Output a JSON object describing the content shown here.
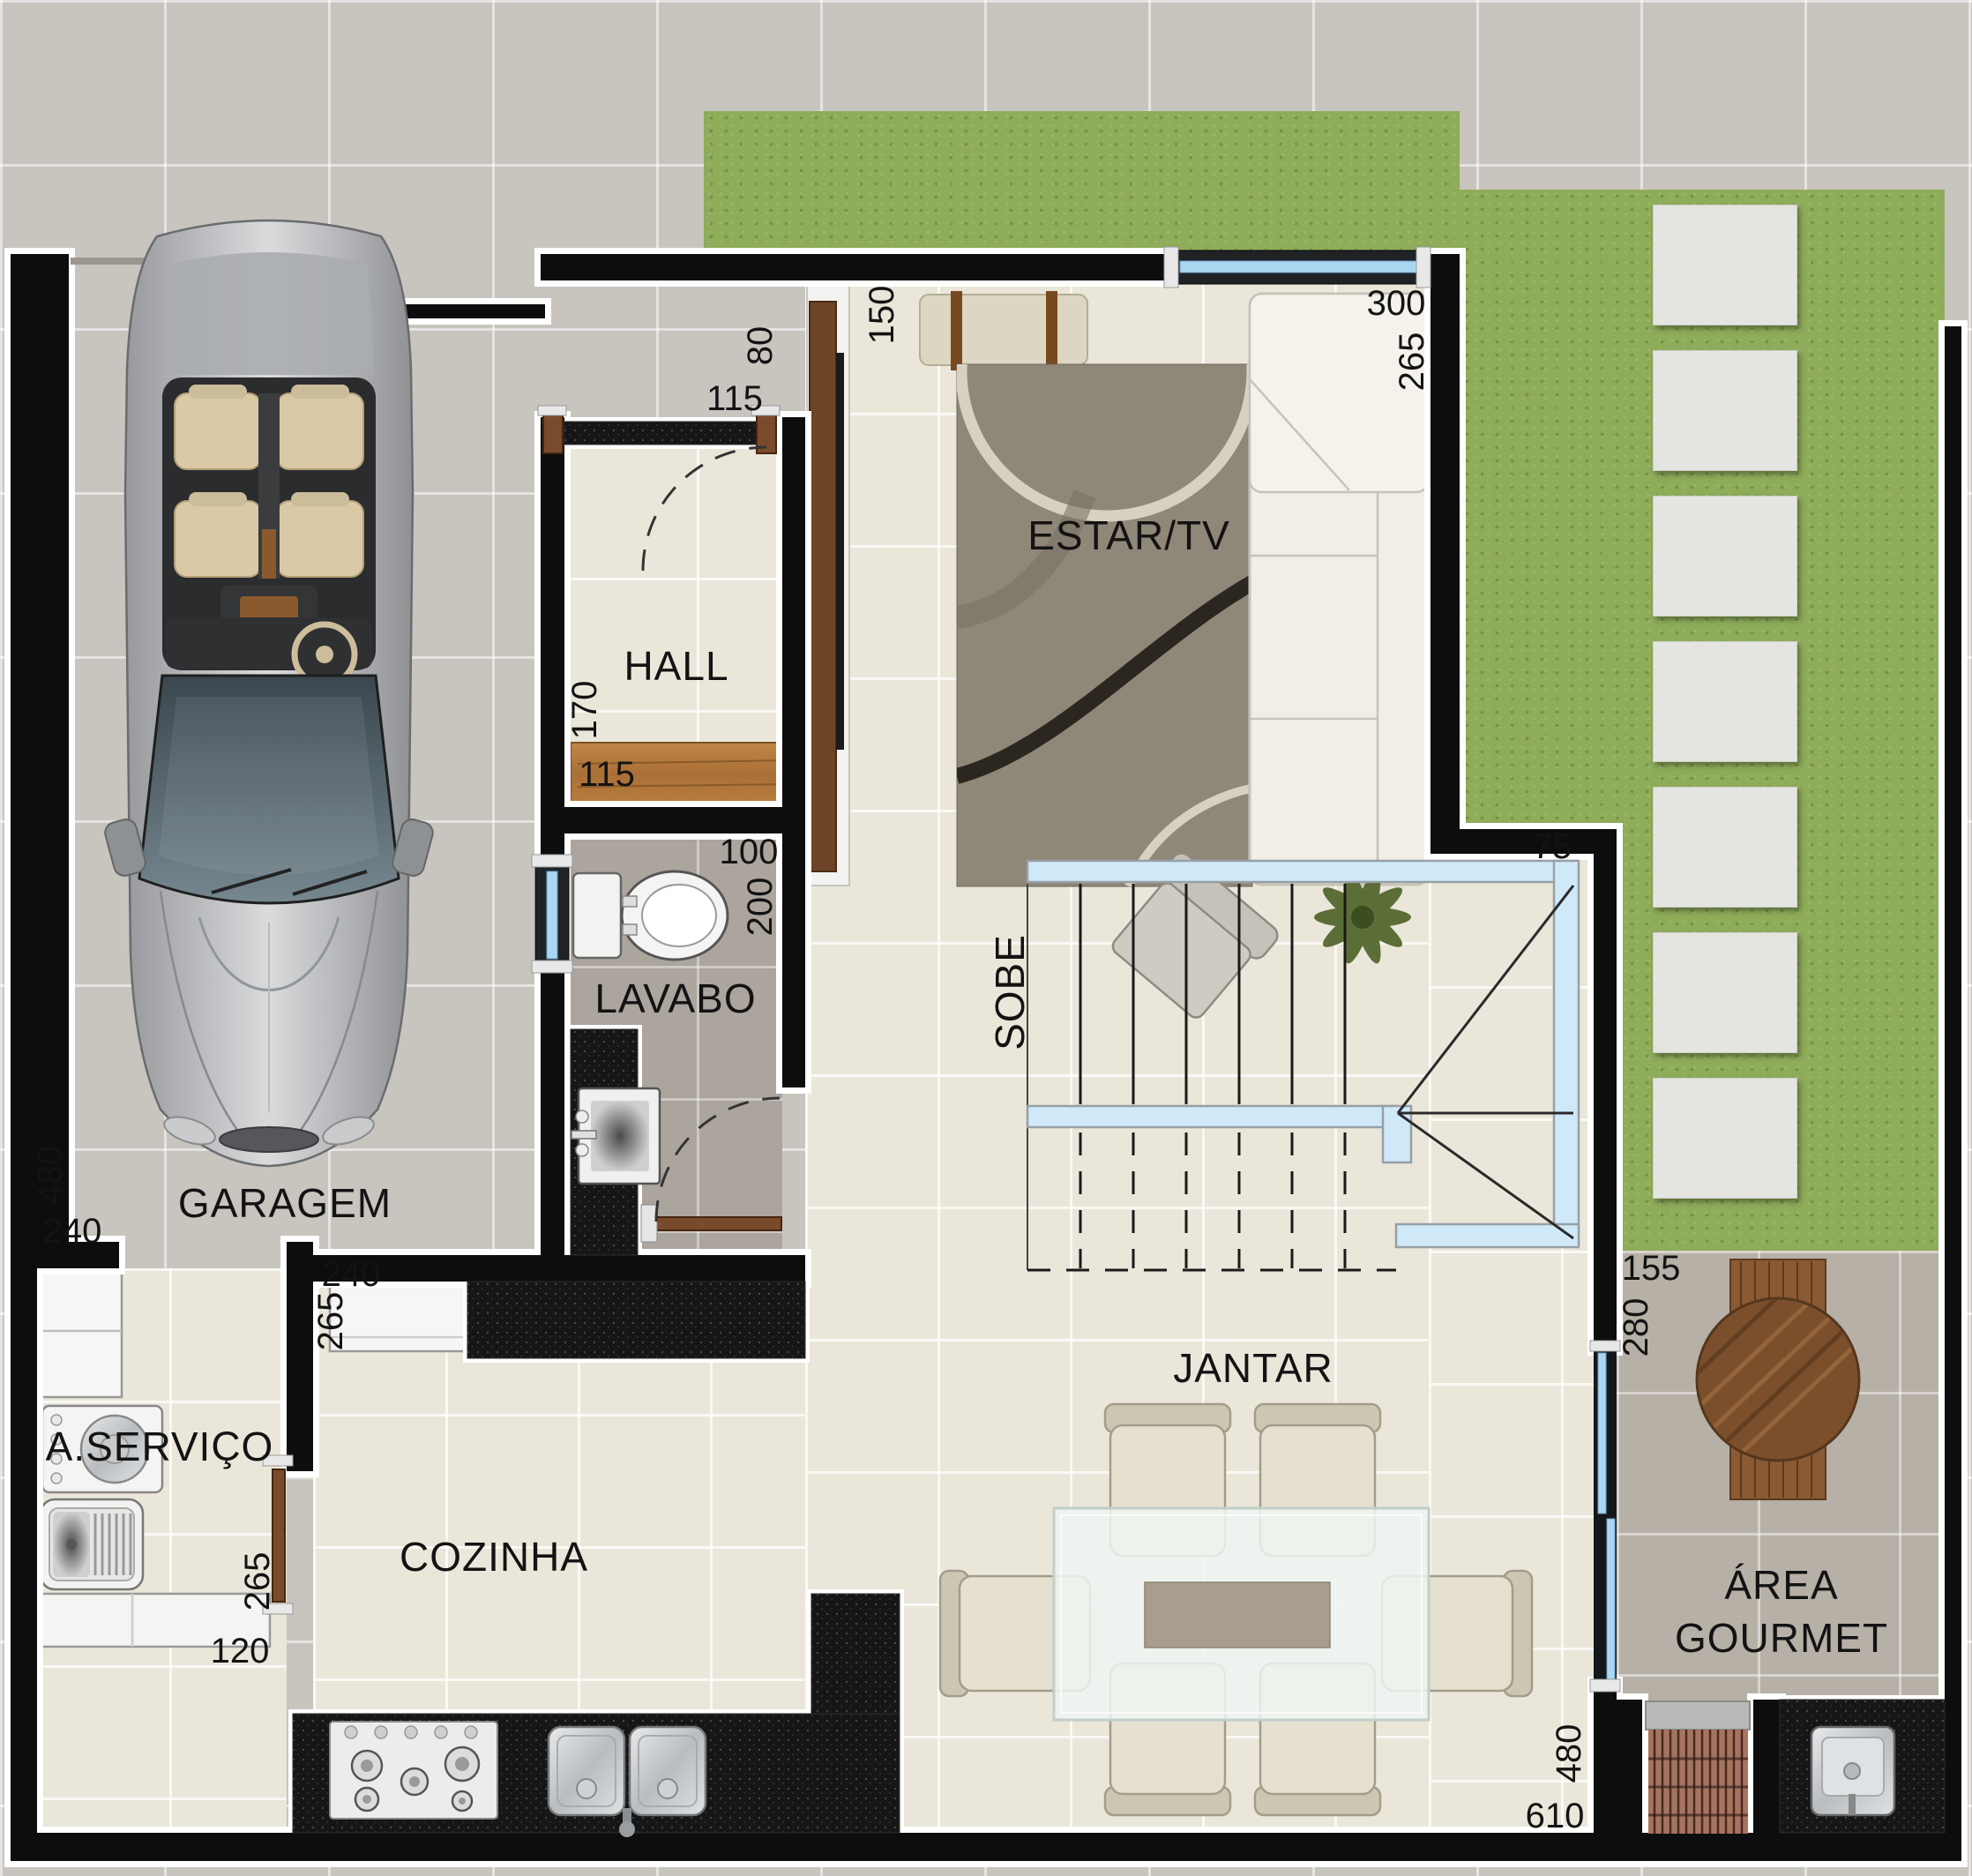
{
  "rooms": {
    "garagem": "GARAGEM",
    "hall": "HALL",
    "lavabo": "LAVABO",
    "estar": "ESTAR/TV",
    "cozinha": "COZINHA",
    "servico": "A.SERVIÇO",
    "jantar": "JANTAR",
    "gourmet_line1": "ÁREA",
    "gourmet_line2": "GOURMET",
    "stairs": "SOBE"
  },
  "dims": {
    "entry_80": "80",
    "entry_115": "115",
    "estar_150": "150",
    "estar_300": "300",
    "estar_265": "265",
    "hall_170": "170",
    "hall_115": "115",
    "lavabo_100": "100",
    "lavabo_200": "200",
    "stair_75": "75",
    "garagem_480": "480",
    "garagem_240": "240",
    "cozinha_240": "240",
    "cozinha_265": "265",
    "servico_265": "265",
    "servico_120": "120",
    "jantar_480": "480",
    "jantar_610": "610",
    "gourmet_155": "155",
    "gourmet_280": "280"
  },
  "colors": {
    "wall": "#0d0d0d",
    "wall_outline": "#ffffff",
    "glass": "#a9d7f2",
    "grass": "#8eac59",
    "door_wood": "#7a4a2c",
    "bench_wood": "#b1793e",
    "granite": "#161616",
    "floor_beige": "#eae6d9",
    "floor_gray": "#aba59d",
    "driveway_tile": "#c8c4be",
    "stepping_stone": "#e4e4e1"
  }
}
